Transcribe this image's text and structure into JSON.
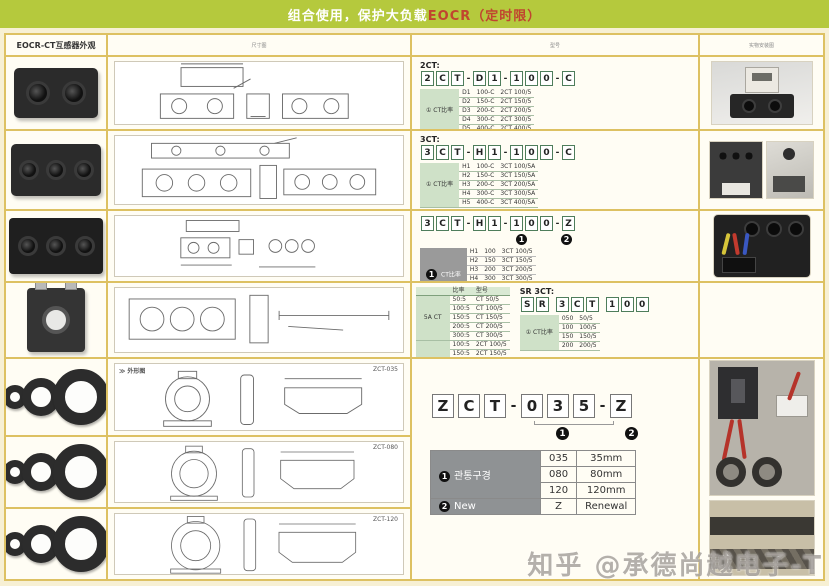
{
  "banner": {
    "text_main": "组合使用，保护大负载",
    "text_accent": "EOCR（定时限）"
  },
  "headers": {
    "col1": "EOCR-CT互感器外观",
    "col2": "尺寸图",
    "col3": "型号",
    "col4": "实物安装图"
  },
  "bullets": {
    "one": "1",
    "two": "2"
  },
  "sections": {
    "s2ct": {
      "label": "2CT:",
      "code": [
        "2",
        "C",
        "T",
        "-",
        "D",
        "1",
        "-",
        "1",
        "0",
        "0",
        "-",
        "C"
      ],
      "table": {
        "group_label": "① CT比率",
        "rows": [
          [
            "D1",
            "100-C",
            "2CT 100/5"
          ],
          [
            "D2",
            "150-C",
            "2CT 150/5"
          ],
          [
            "D3",
            "200-C",
            "2CT 200/5"
          ],
          [
            "D4",
            "300-C",
            "2CT 300/5"
          ],
          [
            "D5",
            "400-C",
            "2CT 400/5"
          ]
        ]
      }
    },
    "s3ct": {
      "label": "3CT:",
      "code": [
        "3",
        "C",
        "T",
        "-",
        "H",
        "1",
        "-",
        "1",
        "0",
        "0",
        "-",
        "C"
      ],
      "table": {
        "group_label": "① CT比率",
        "rows": [
          [
            "H1",
            "100-C",
            "3CT 100/5A"
          ],
          [
            "H2",
            "150-C",
            "3CT 150/5A"
          ],
          [
            "H3",
            "200-C",
            "3CT 200/5A"
          ],
          [
            "H4",
            "300-C",
            "3CT 300/5A"
          ],
          [
            "H5",
            "400-C",
            "3CT 400/5A"
          ]
        ]
      }
    },
    "s3ctz": {
      "code": [
        "3",
        "C",
        "T",
        "-",
        "H",
        "1",
        "-",
        "1",
        "0",
        "0",
        "-",
        "Z"
      ],
      "table": {
        "group_label": {
          "bullet": "1",
          "text": "CT比率"
        },
        "rows": [
          [
            "H1",
            "100",
            "3CT 100/5"
          ],
          [
            "H2",
            "150",
            "3CT 150/5"
          ],
          [
            "H3",
            "200",
            "3CT 200/5"
          ],
          [
            "H4",
            "300",
            "3CT 300/5"
          ],
          [
            "H5",
            "400",
            "3CT 400/5"
          ],
          [
            "H6",
            "500",
            "3CT 500/5"
          ]
        ],
        "footer": {
          "label": {
            "bullet": "2",
            "text": "New"
          },
          "code": "Z",
          "value": "Renewal"
        }
      }
    },
    "ratio": {
      "table": {
        "headers": [
          "",
          "比率",
          "型号"
        ],
        "groups": [
          {
            "label": "5A CT",
            "rows": [
              [
                "50:5",
                "CT 50/5"
              ],
              [
                "100:5",
                "CT 100/5"
              ],
              [
                "150:5",
                "CT 150/5"
              ],
              [
                "200:5",
                "CT 200/5"
              ],
              [
                "300:5",
                "CT 300/5"
              ]
            ]
          },
          {
            "label": "2CT 5A",
            "rows": [
              [
                "100:5",
                "2CT 100/5"
              ],
              [
                "150:5",
                "2CT 150/5"
              ],
              [
                "200:5",
                "2CT 200/5"
              ],
              [
                "300:5",
                "2CT 300/5"
              ],
              [
                "400:5",
                "2CT 400/5"
              ]
            ]
          },
          {
            "label": "3CT 5A",
            "rows": [
              [
                "100:5",
                "3CT 100/5"
              ],
              [
                "150:5",
                "3CT 150/5"
              ],
              [
                "200:5",
                "3CT 200/5"
              ],
              [
                "300:5",
                "3CT 300/5"
              ],
              [
                "400:5",
                "3CT 400/5"
              ]
            ]
          }
        ]
      }
    },
    "srct": {
      "label": "SR 3CT:",
      "code": [
        "S",
        "R",
        " ",
        "3",
        "C",
        "T",
        " ",
        "1",
        "0",
        "0"
      ],
      "table": {
        "group_label": "① CT比率",
        "rows": [
          [
            "050",
            "50/5"
          ],
          [
            "100",
            "100/5"
          ],
          [
            "150",
            "150/5"
          ],
          [
            "200",
            "200/5"
          ]
        ]
      }
    },
    "zct": {
      "code": [
        "Z",
        "C",
        "T",
        "-",
        "0",
        "3",
        "5",
        "-",
        "Z"
      ],
      "table": {
        "group_label": {
          "bullet": "1",
          "text": "관통구경"
        },
        "rows": [
          [
            "035",
            "35mm"
          ],
          [
            "080",
            "80mm"
          ],
          [
            "120",
            "120mm"
          ]
        ],
        "footer": {
          "label": {
            "bullet": "2",
            "text": "New"
          },
          "code": "Z",
          "value": "Renewal"
        }
      }
    }
  },
  "drawings": {
    "row5_header": "≫ 外形图",
    "row5_model": "ZCT-035",
    "row6_model": "ZCT-080",
    "row7_model": "ZCT-120"
  },
  "watermark": "知乎 @承德尚越电子-T",
  "colors": {
    "banner_green": "#b5c93d",
    "border_yellow": "#ddc162",
    "accent_red": "#c0452f",
    "table_green": "#cfe1c8",
    "table_grey": "#8f9294"
  }
}
